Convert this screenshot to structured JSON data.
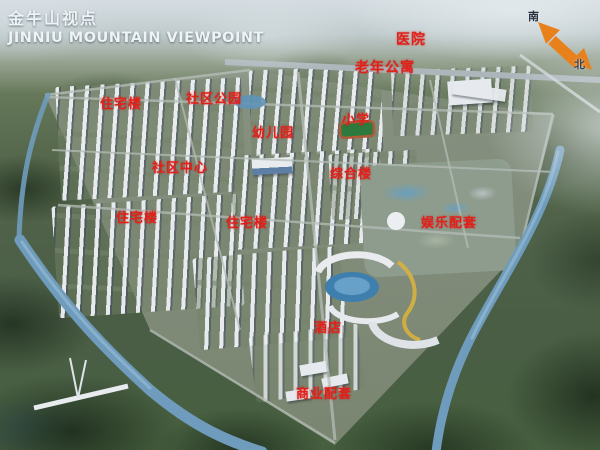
{
  "title": {
    "cn": "金牛山视点",
    "en": "JINNIU MOUNTAIN VIEWPOINT"
  },
  "compass": {
    "south": "南",
    "north": "北",
    "arrow_color": "#e8811c"
  },
  "labels": [
    {
      "id": "hospital",
      "text": "医院",
      "x": 396,
      "y": 29,
      "size": 14
    },
    {
      "id": "senior-apartments",
      "text": "老年公寓",
      "x": 355,
      "y": 57,
      "size": 14
    },
    {
      "id": "residential-a",
      "text": "住宅楼",
      "x": 100,
      "y": 93,
      "size": 13
    },
    {
      "id": "community-park",
      "text": "社区公园",
      "x": 186,
      "y": 88,
      "size": 13
    },
    {
      "id": "kindergarten",
      "text": "幼儿园",
      "x": 252,
      "y": 122,
      "size": 13
    },
    {
      "id": "primary-school",
      "text": "小学",
      "x": 342,
      "y": 109,
      "size": 13
    },
    {
      "id": "community-center",
      "text": "社区中心",
      "x": 152,
      "y": 157,
      "size": 13
    },
    {
      "id": "complex-building",
      "text": "综合楼",
      "x": 330,
      "y": 163,
      "size": 13
    },
    {
      "id": "residential-b",
      "text": "住宅楼",
      "x": 116,
      "y": 207,
      "size": 13
    },
    {
      "id": "residential-c",
      "text": "住宅楼",
      "x": 226,
      "y": 212,
      "size": 13
    },
    {
      "id": "entertainment-facilities",
      "text": "娱乐配套",
      "x": 421,
      "y": 212,
      "size": 13
    },
    {
      "id": "hotel",
      "text": "酒店",
      "x": 314,
      "y": 317,
      "size": 13
    },
    {
      "id": "commercial-facilities",
      "text": "商业配套",
      "x": 296,
      "y": 383,
      "size": 13
    }
  ],
  "colors": {
    "label_red": "#e2201a",
    "title_white": "#eef3f5",
    "water_blue": "#6f9cbd",
    "lake_blue": "#3f7fae",
    "arrow_orange": "#e8811c"
  }
}
